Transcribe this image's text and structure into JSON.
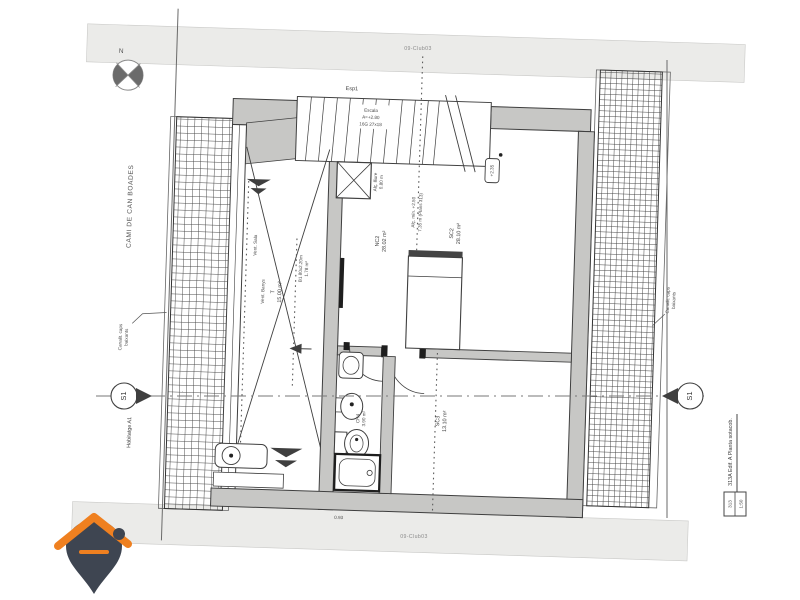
{
  "sheet": {
    "ref_top": "09-Club03",
    "ref_bottom": "09-Club03",
    "title": "313A Edif. A Planta sotacob.",
    "sheet_code": "313",
    "scale": "1:50"
  },
  "compass": {
    "north": "N"
  },
  "site": {
    "street": "CAMI DE CAN BOADES",
    "dwelling": "Habitatge A1",
    "canal_left": {
      "l1": "Canalit. caps",
      "l2": "baixants"
    },
    "canal_right": {
      "l1": "Canalit. caps",
      "l2": "baixants"
    }
  },
  "section": {
    "left": "S1",
    "right": "S1"
  },
  "stair": {
    "l1": "Escala",
    "l2": "A=+2.80",
    "l3": "16G 27x18"
  },
  "rooms": {
    "t": {
      "name": "T",
      "area": "15.00 m²"
    },
    "b1": {
      "name": "B1 80x2.20m",
      "area": "1.78 m²"
    },
    "nc2": {
      "name": "NC2",
      "area": "28.02 m²"
    },
    "sc2": {
      "name": "SC2",
      "area": "28.10 m²"
    },
    "sc3": {
      "name": "SC3",
      "area": "13.10 m²"
    },
    "ch4": {
      "name": "CH4",
      "area": "3.90 m²"
    }
  },
  "annotations": {
    "vent_sala": "Vent. Sala",
    "vent_banys": "Vent. Banys",
    "ridge1": "Alç. mín. +2.50",
    "ridge2": "7.35 m (Plans 313)",
    "shaft1": "Alç. lliure",
    "shaft2": "0.80 m",
    "level": "+2.35",
    "esp": "Esp1",
    "dim": "0.93"
  },
  "colors": {
    "wall": "#c7c7c5",
    "band": "#ebebe9",
    "line": "#3f3f3f",
    "logo_orange": "#ef8020",
    "logo_dark": "#3e4551"
  }
}
